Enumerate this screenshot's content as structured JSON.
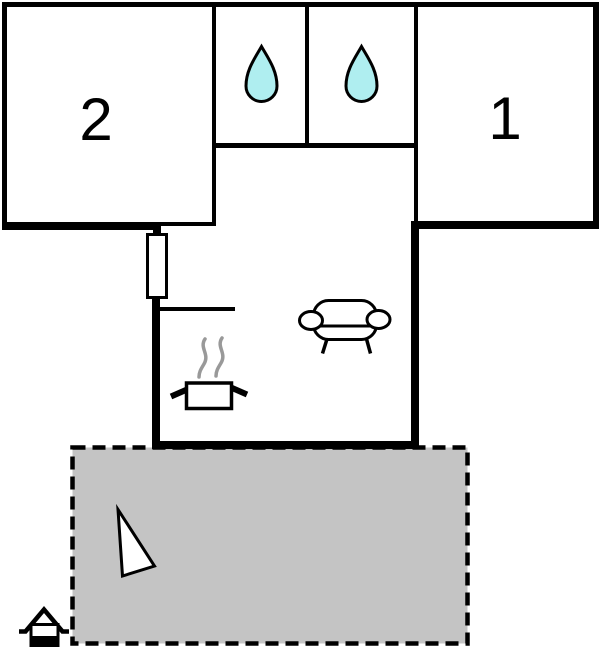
{
  "rooms": {
    "room_1": {
      "label": "1"
    },
    "room_2": {
      "label": "2"
    }
  },
  "icons": {
    "bathroom_left": "water-drop-icon",
    "bathroom_right": "water-drop-icon",
    "living_area": "sofa-icon",
    "kitchen": "cooking-pot-icon",
    "terrace": "north-arrow-icon",
    "site": "house-icon"
  },
  "colors": {
    "background": "#ffffff",
    "wall": "#000000",
    "terrace_fill": "#c4c4c4",
    "water_drop_fill": "#afeef0",
    "steam": "#999999",
    "icon_fill": "#ffffff"
  }
}
